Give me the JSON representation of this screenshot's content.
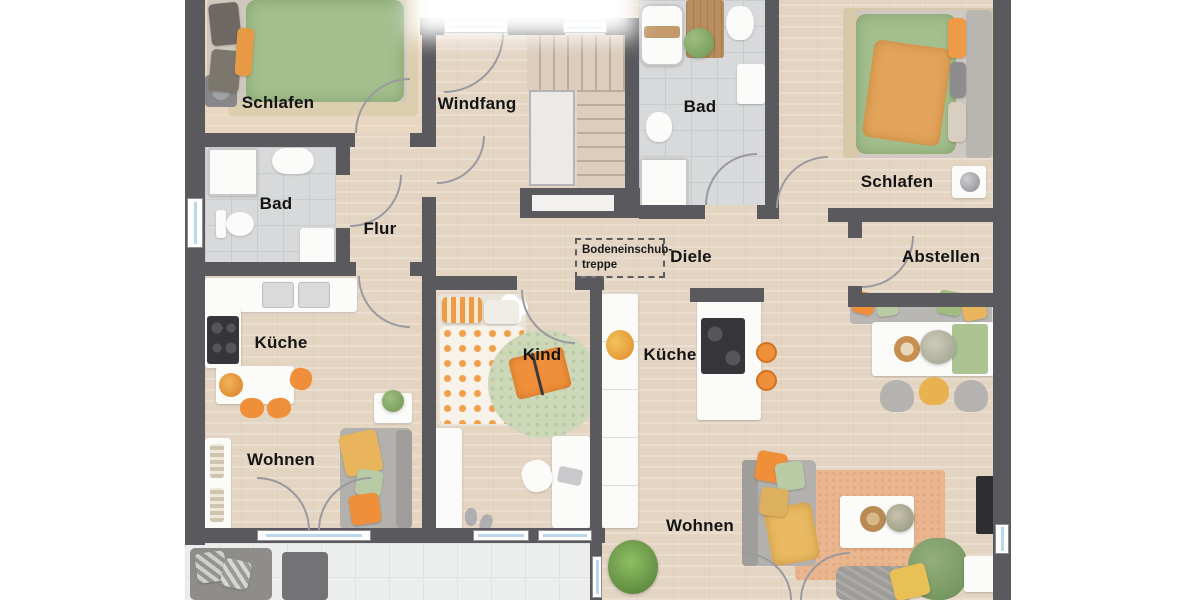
{
  "view": {
    "type": "floor-plan-render",
    "background": "#ffffff"
  },
  "rooms": {
    "schlafen_left": {
      "label": "Schlafen"
    },
    "windfang": {
      "label": "Windfang"
    },
    "bad_top": {
      "label": "Bad"
    },
    "schlafen_right": {
      "label": "Schlafen"
    },
    "bad_left": {
      "label": "Bad"
    },
    "flur": {
      "label": "Flur"
    },
    "diele": {
      "label": "Diele"
    },
    "abstellen": {
      "label": "Abstellen"
    },
    "kueche_left": {
      "label": "Küche"
    },
    "kind": {
      "label": "Kind"
    },
    "kueche_right": {
      "label": "Küche"
    },
    "wohnen_left": {
      "label": "Wohnen"
    },
    "wohnen_right": {
      "label": "Wohnen"
    }
  },
  "annotation": {
    "loft_ladder_line1": "Bodeneinschub-",
    "loft_ladder_line2": "treppe"
  },
  "colors": {
    "wall": "#5a5a5e",
    "wood_floor": "#e4d5c3",
    "tile_floor": "#d7d9da",
    "terrace_floor": "#eceeed",
    "accent_orange": "#ef8f3a",
    "accent_green": "#a3bf8d",
    "accent_yellow": "#e8b45c",
    "label_text": "#141414"
  }
}
